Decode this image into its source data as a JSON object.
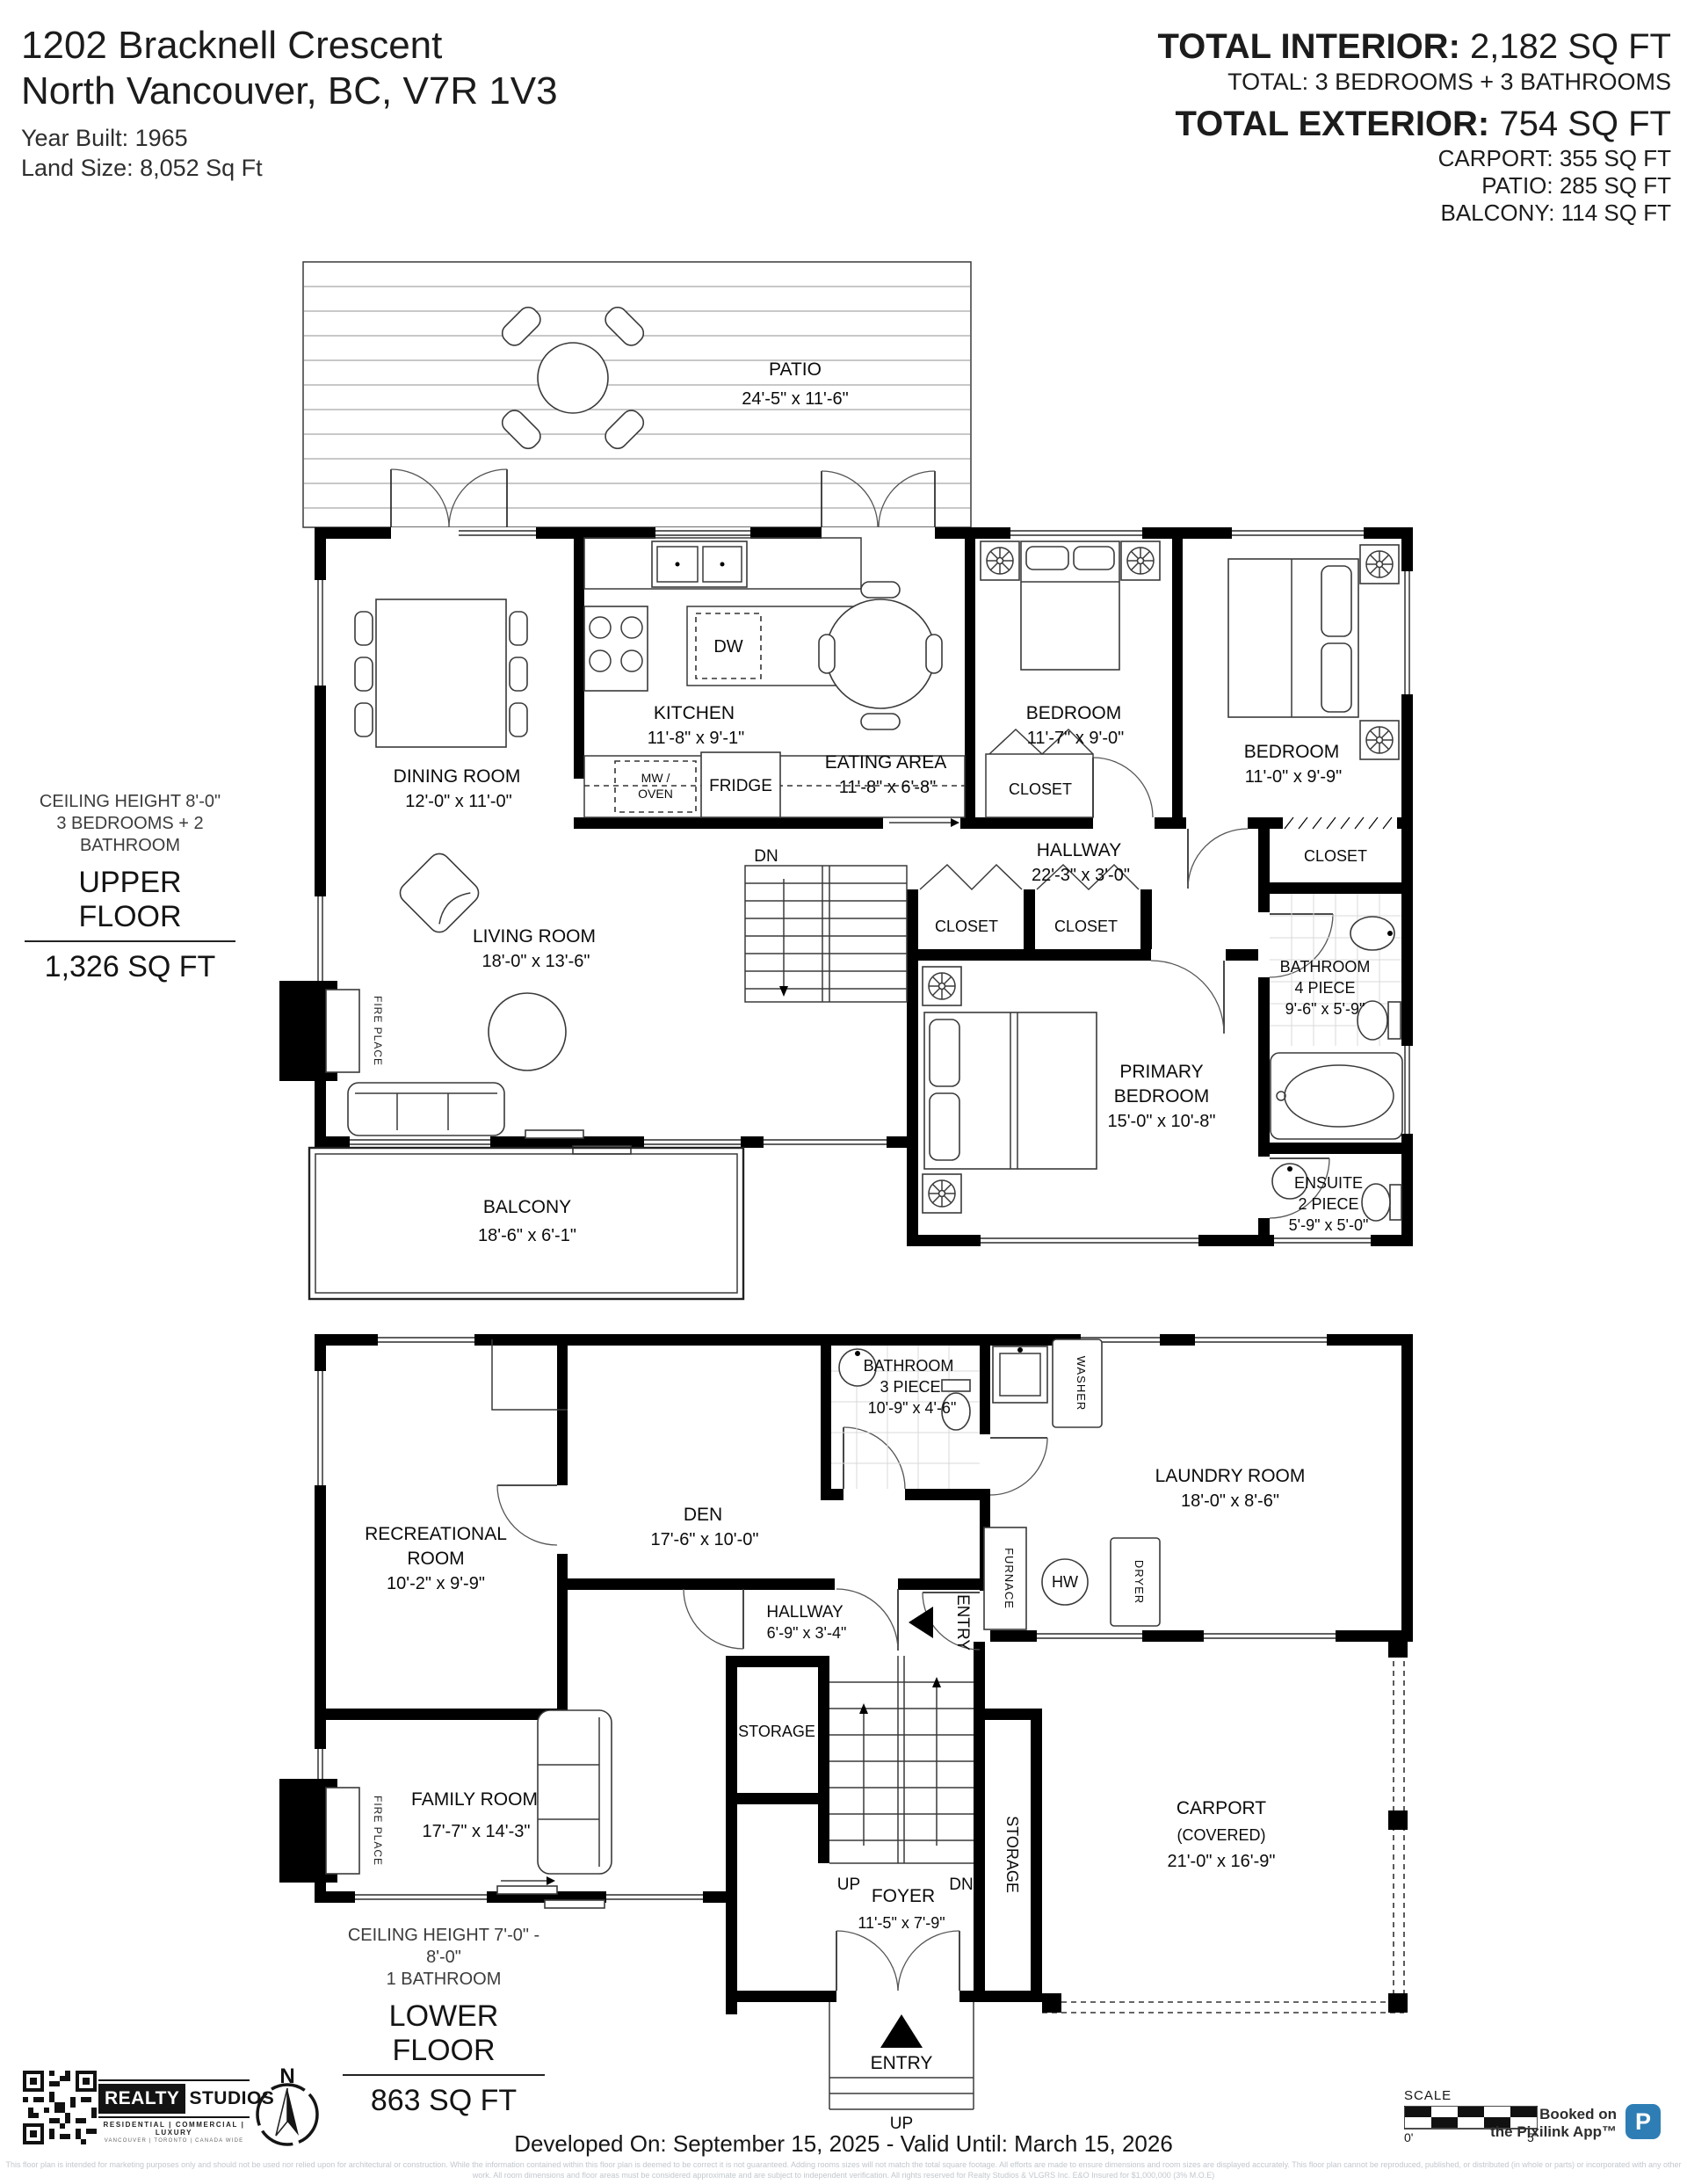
{
  "header": {
    "address_line1": "1202 Bracknell Crescent",
    "address_line2": "North Vancouver, BC, V7R 1V3",
    "year_built": "Year Built: 1965",
    "land_size": "Land Size: 8,052 Sq Ft",
    "total_interior_label": "TOTAL INTERIOR:",
    "total_interior_value": " 2,182 SQ FT",
    "total_rooms": "TOTAL: 3 BEDROOMS + 3 BATHROOMS",
    "total_exterior_label": "TOTAL EXTERIOR:",
    "total_exterior_value": " 754 SQ FT",
    "exterior_breakdown": {
      "carport": "CARPORT: 355 SQ FT",
      "patio": "PATIO: 285 SQ FT",
      "balcony": "BALCONY: 114 SQ FT"
    }
  },
  "upper_floor": {
    "ceiling": "CEILING HEIGHT 8'-0\"",
    "summary": "3 BEDROOMS + 2 BATHROOM",
    "title": "UPPER FLOOR",
    "area": "1,326 SQ FT",
    "rooms": {
      "patio": {
        "name": "PATIO",
        "dims": "24'-5\" x 11'-6\""
      },
      "dining_room": {
        "name": "DINING ROOM",
        "dims": "12'-0\" x 11'-0\""
      },
      "kitchen": {
        "name": "KITCHEN",
        "dims": "11'-8\" x 9'-1\""
      },
      "eating_area": {
        "name": "EATING AREA",
        "dims": "11'-8\" x 6'-8\""
      },
      "bedroom_front": {
        "name": "BEDROOM",
        "dims": "11'-7\" x 9'-0\""
      },
      "bedroom_corner": {
        "name": "BEDROOM",
        "dims": "11'-0\" x 9'-9\""
      },
      "hallway": {
        "name": "HALLWAY",
        "dims": "22'-3\" x 3'-0\""
      },
      "living_room": {
        "name": "LIVING ROOM",
        "dims": "18'-0\" x 13'-6\""
      },
      "primary_bedroom": {
        "name": "PRIMARY",
        "name2": "BEDROOM",
        "dims": "15'-0\" x 10'-8\""
      },
      "bathroom": {
        "name": "BATHROOM",
        "type": "4 PIECE",
        "dims": "9'-6\" x 5'-9\""
      },
      "ensuite": {
        "name": "ENSUITE",
        "type": "2 PIECE",
        "dims": "5'-9\" x 5'-0\""
      },
      "balcony": {
        "name": "BALCONY",
        "dims": "18'-6\" x 6'-1\""
      }
    },
    "labels": {
      "closet": "CLOSET",
      "dn": "DN",
      "fireplace": "FIRE PLACE",
      "dw": "DW",
      "mw": "MW /",
      "oven": "OVEN",
      "fridge": "FRIDGE"
    }
  },
  "lower_floor": {
    "ceiling": "CEILING HEIGHT 7'-0\" - 8'-0\"",
    "summary": "1 BATHROOM",
    "title": "LOWER FLOOR",
    "area": "863 SQ FT",
    "rooms": {
      "recreational_room": {
        "name": "RECREATIONAL",
        "name2": "ROOM",
        "dims": "10'-2\" x 9'-9\""
      },
      "den": {
        "name": "DEN",
        "dims": "17'-6\" x 10'-0\""
      },
      "bathroom": {
        "name": "BATHROOM",
        "type": "3 PIECE",
        "dims": "10'-9\" x 4'-6\""
      },
      "laundry_room": {
        "name": "LAUNDRY ROOM",
        "dims": "18'-0\" x 8'-6\""
      },
      "hallway": {
        "name": "HALLWAY",
        "dims": "6'-9\" x 3'-4\""
      },
      "family_room": {
        "name": "FAMILY ROOM",
        "dims": "17'-7\" x 14'-3\""
      },
      "foyer": {
        "name": "FOYER",
        "dims": "11'-5\" x 7'-9\""
      },
      "carport": {
        "name": "CARPORT",
        "type": "(COVERED)",
        "dims": "21'-0\" x 16'-9\""
      }
    },
    "labels": {
      "storage": "STORAGE",
      "entry": "ENTRY",
      "up": "UP",
      "dn": "DN",
      "washer": "WASHER",
      "dryer": "DRYER",
      "furnace": "FURNACE",
      "hw": "HW",
      "fireplace": "FIRE PLACE"
    }
  },
  "footer": {
    "brand": {
      "name_left": "REALTY",
      "name_right": "STUDIOS",
      "tagline": "RESIDENTIAL | COMMERCIAL | LUXURY",
      "subline": "VANCOUVER | TORONTO | CANADA WIDE"
    },
    "compass_north": "N",
    "validity": "Developed On: September 15, 2025 - Valid Until: March 15, 2026",
    "scale_label": "SCALE",
    "scale_start": "0'",
    "scale_end": "5'",
    "booked_line1": "Booked on",
    "booked_line2": "the Pixilink App™",
    "app_icon_letter": "P",
    "app_icon_color": "#2e7eb5",
    "wall_color": "#000000",
    "disclaimer_line1": "This floor plan is intended for marketing purposes only and should not be used nor relied upon for architectural or construction. While the information contained within this floor plan is deemed to be correct it is not guaranteed. Adding rooms sizes will not match the total square footage. All efforts are made to ensure dimensions and room sizes are displayed accurately. This floor plan cannot be reproduced, published, or distributed (in whole or parts) or incorporated with any other",
    "disclaimer_line2": "work. All room dimensions and floor areas must be considered approximate and are subject to independent verification. All rights reserved for Realty Studios & VLGRS Inc. E&O Insured for $1,000,000 (3% M.O.E)"
  }
}
